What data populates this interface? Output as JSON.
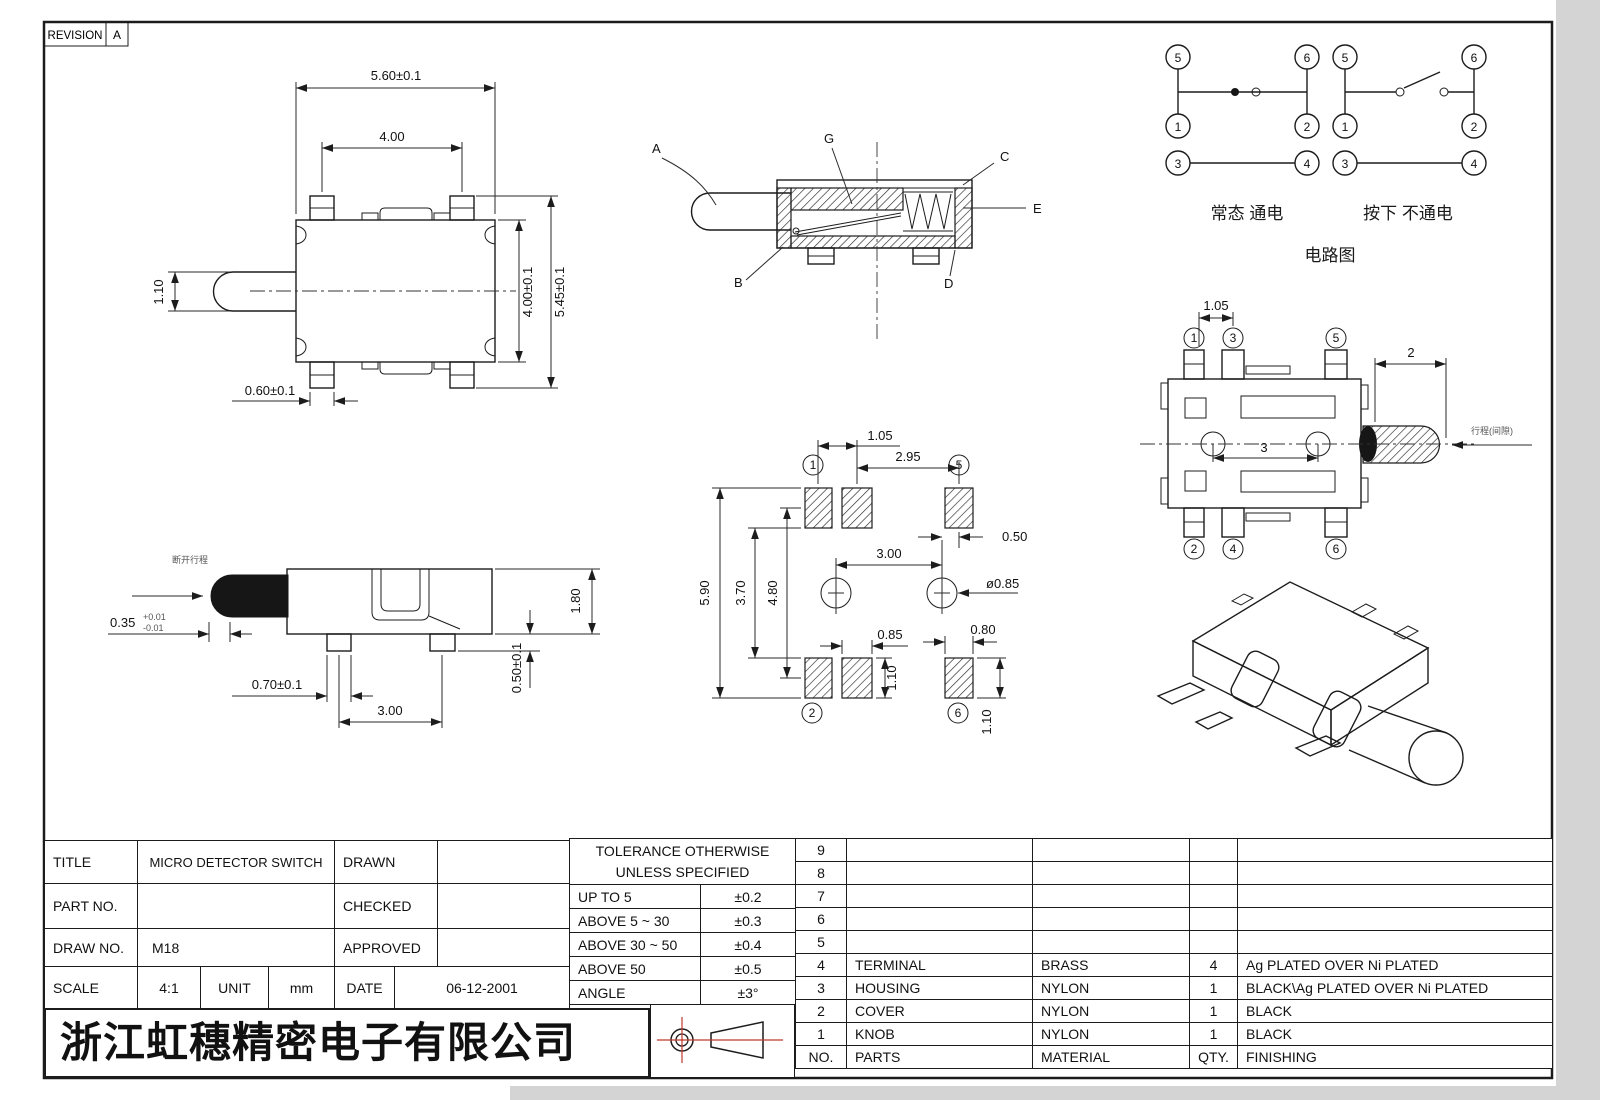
{
  "revision": {
    "label": "REVISION",
    "value": "A"
  },
  "front_view": {
    "width": "5.60±0.1",
    "pin_pitch": "4.00",
    "knob_height": "1.10",
    "body_height": "4.00±0.1",
    "total_height": "5.45±0.1",
    "pin_width": "0.60±0.1"
  },
  "section_view": {
    "a": "A",
    "b": "B",
    "c": "C",
    "d": "D",
    "e": "E",
    "g": "G"
  },
  "circuit": {
    "pins": {
      "p1": "1",
      "p2": "2",
      "p3": "3",
      "p4": "4",
      "p5": "5",
      "p6": "6"
    },
    "caption_normal": "常态 通电",
    "caption_pressed": "按下 不通电",
    "title": "电路图"
  },
  "top_view": {
    "pins": {
      "p1": "1",
      "p2": "2",
      "p3": "3",
      "p4": "4",
      "p5": "5",
      "p6": "6"
    },
    "pad_pitch": "1.05",
    "travel": "2",
    "hole_pitch": "3",
    "note": "行程(间隙)"
  },
  "land_pattern": {
    "pads": {
      "p1": "1",
      "p2": "2",
      "p5": "5",
      "p6": "6"
    },
    "pad_pitch": "1.05",
    "pitch_1_5": "2.95",
    "hole_offset": "0.50",
    "hole_pitch": "3.00",
    "hole_dia": "ø0.85",
    "span_outer": "5.90",
    "span_inner": "3.70",
    "span_center": "4.80",
    "pad_width": "0.85",
    "pad_height": "1.10",
    "pad6_width": "0.80",
    "pad6_height": "1.10"
  },
  "side_view": {
    "tip": "0.35",
    "tip_plus": "+0.01",
    "tip_minus": "-0.01",
    "pin_width": "0.70±0.1",
    "pin_pitch": "3.00",
    "height": "1.80",
    "pin_height": "0.50±0.1",
    "note": "断开行程"
  },
  "title_block": {
    "title_label": "TITLE",
    "title_value": "MICRO DETECTOR SWITCH",
    "part_label": "PART NO.",
    "part_value": "",
    "draw_label": "DRAW NO.",
    "draw_value": "M18",
    "scale_label": "SCALE",
    "scale_value": "4:1",
    "unit_label": "UNIT",
    "unit_value": "mm",
    "date_label": "DATE",
    "date_value": "06-12-2001",
    "drawn_label": "DRAWN",
    "drawn_value": "",
    "checked_label": "CHECKED",
    "checked_value": "",
    "approved_label": "APPROVED",
    "approved_value": ""
  },
  "tolerance_table": {
    "header_line1": "TOLERANCE OTHERWISE",
    "header_line2": "UNLESS SPECIFIED",
    "rows": [
      {
        "range": "UP TO 5",
        "tol": "±0.2"
      },
      {
        "range": "ABOVE 5 ~ 30",
        "tol": "±0.3"
      },
      {
        "range": "ABOVE 30 ~ 50",
        "tol": "±0.4"
      },
      {
        "range": "ABOVE 50",
        "tol": "±0.5"
      },
      {
        "range": "ANGLE",
        "tol": "±3°"
      }
    ]
  },
  "parts_table": {
    "headers": {
      "no": "NO.",
      "parts": "PARTS",
      "material": "MATERIAL",
      "qty": "QTY.",
      "finishing": "FINISHING"
    },
    "rows": [
      {
        "no": "9",
        "parts": "",
        "material": "",
        "qty": "",
        "finishing": ""
      },
      {
        "no": "8",
        "parts": "",
        "material": "",
        "qty": "",
        "finishing": ""
      },
      {
        "no": "7",
        "parts": "",
        "material": "",
        "qty": "",
        "finishing": ""
      },
      {
        "no": "6",
        "parts": "",
        "material": "",
        "qty": "",
        "finishing": ""
      },
      {
        "no": "5",
        "parts": "",
        "material": "",
        "qty": "",
        "finishing": ""
      },
      {
        "no": "4",
        "parts": "TERMINAL",
        "material": "BRASS",
        "qty": "4",
        "finishing": "Ag PLATED OVER Ni PLATED"
      },
      {
        "no": "3",
        "parts": "HOUSING",
        "material": "NYLON",
        "qty": "1",
        "finishing": "BLACK\\Ag PLATED OVER Ni PLATED"
      },
      {
        "no": "2",
        "parts": "COVER",
        "material": "NYLON",
        "qty": "1",
        "finishing": "BLACK"
      },
      {
        "no": "1",
        "parts": "KNOB",
        "material": "NYLON",
        "qty": "1",
        "finishing": "BLACK"
      }
    ]
  },
  "company": {
    "name": "浙江虹穗精密电子有限公司"
  },
  "colors": {
    "line": "#1c1c1c",
    "accent_red": "#c0392b"
  }
}
